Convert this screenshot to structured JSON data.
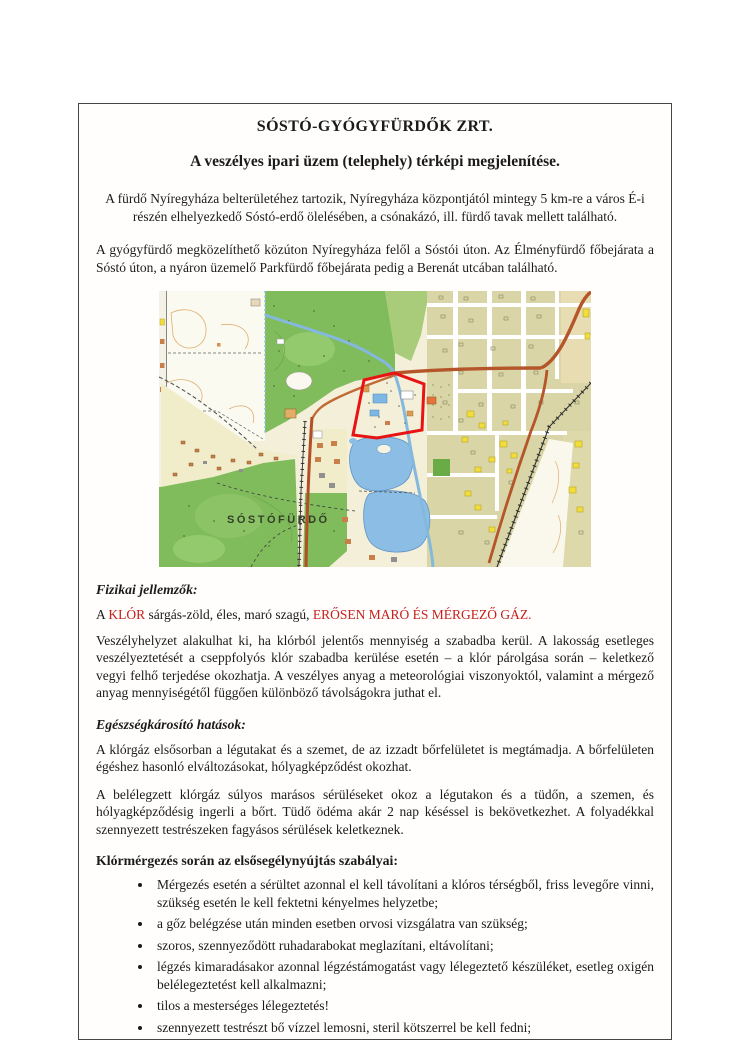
{
  "page": {
    "title": "SÓSTÓ-GYÓGYFÜRDŐK ZRT.",
    "subtitle": "A veszélyes ipari üzem (telephely) térképi megjelenítése.",
    "intro_p1": "A fürdő Nyíregyháza belterületéhez tartozik, Nyíregyháza központjától mintegy 5 km-re a város É-i részén elhelyezkedő Sóstó-erdő ölelésében, a csónakázó, ill. fürdő tavak mellett található.",
    "intro_p2": "A gyógyfürdő megközelíthető közúton Nyíregyháza felől a Sóstói úton. Az Élményfürdő főbejárata a Sóstó úton, a nyáron üzemelő Parkfürdő főbejárata pedig a Berenát utcában található."
  },
  "map": {
    "label": "SÓSTÓFÜRDŐ",
    "colors": {
      "paper": "#f3efd9",
      "forest_green": "#81bc5c",
      "water_blue": "#8cbde4",
      "urban_olive": "#d9d5a7",
      "highlight_yellow": "#f1de3d",
      "road_brown": "#b5552a",
      "site_outline_red": "#e81414"
    }
  },
  "sections": {
    "fizikai": {
      "heading": "Fizikai jellemzők:",
      "line_prefix": "A ",
      "klor": "KLÓR",
      "line_mid": " sárgás-zöld, éles, maró szagú, ",
      "danger": "ERŐSEN MARÓ ÉS MÉRGEZŐ GÁZ",
      "line_end": ".",
      "para": "Veszélyhelyzet alakulhat ki, ha klórból jelentős mennyiség a szabadba kerül. A lakosság esetleges veszélyeztetését a cseppfolyós klór szabadba kerülése esetén – a klór párolgása során – keletkező vegyi felhő terjedése okozhatja. A veszélyes anyag a meteorológiai viszonyoktól, valamint a mérgező anyag mennyiségétől függően különböző távolságokra juthat el."
    },
    "egeszseg": {
      "heading": "Egészségkárosító hatások:",
      "para1": "A klórgáz elsősorban a légutakat és a szemet, de az izzadt bőrfelületet is megtámadja. A bőrfelületen égéshez hasonló elváltozásokat, hólyagképződést okozhat.",
      "para2": "A belélegzett klórgáz súlyos marásos sérüléseket okoz a légutakon és a tüdőn, a szemen, és hólyagképződésig ingerli a bőrt. Tüdő ödéma akár 2 nap késéssel is bekövetkezhet. A folyadékkal szennyezett testrészeken fagyásos sérülések keletkeznek."
    },
    "elsosegely": {
      "heading": "Klórmérgezés során az elsősegélynyújtás szabályai:",
      "bullets": [
        "Mérgezés esetén a sérültet azonnal el kell távolítani a klóros térségből, friss levegőre vinni, szükség esetén le kell fektetni kényelmes helyzetbe;",
        "a gőz belégzése után minden esetben orvosi vizsgálatra van szükség;",
        "szoros, szennyeződött ruhadarabokat meglazítani, eltávolítani;",
        "légzés kimaradásakor azonnal légzéstámogatást vagy lélegeztető készüléket, esetleg oxigén belélegeztetést kell alkalmazni;",
        "tilos a mesterséges lélegeztetés!",
        "szennyezett testrészt bő vízzel lemosni, steril kötszerrel be kell fedni;"
      ]
    }
  }
}
